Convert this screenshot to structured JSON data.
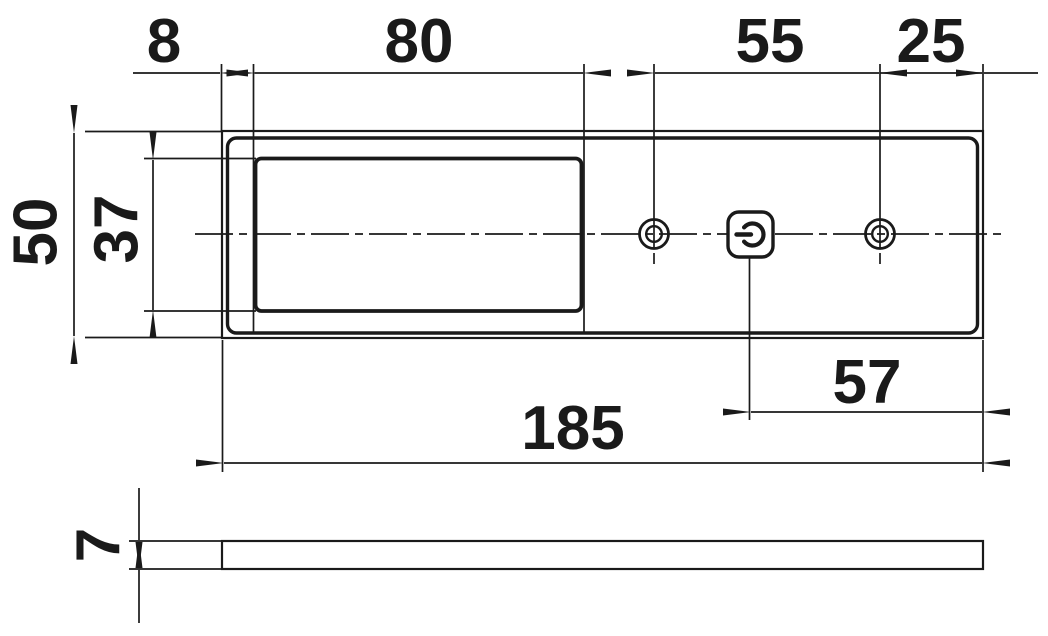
{
  "colors": {
    "line": "#1a1a1a",
    "background": "#ffffff"
  },
  "dims": {
    "left_offset": "8",
    "window_width": "80",
    "hole_spacing": "55",
    "hole_to_right_edge": "25",
    "panel_height": "50",
    "window_height": "37",
    "switch_to_right_edge": "57",
    "panel_length": "185",
    "panel_thickness": "7"
  }
}
